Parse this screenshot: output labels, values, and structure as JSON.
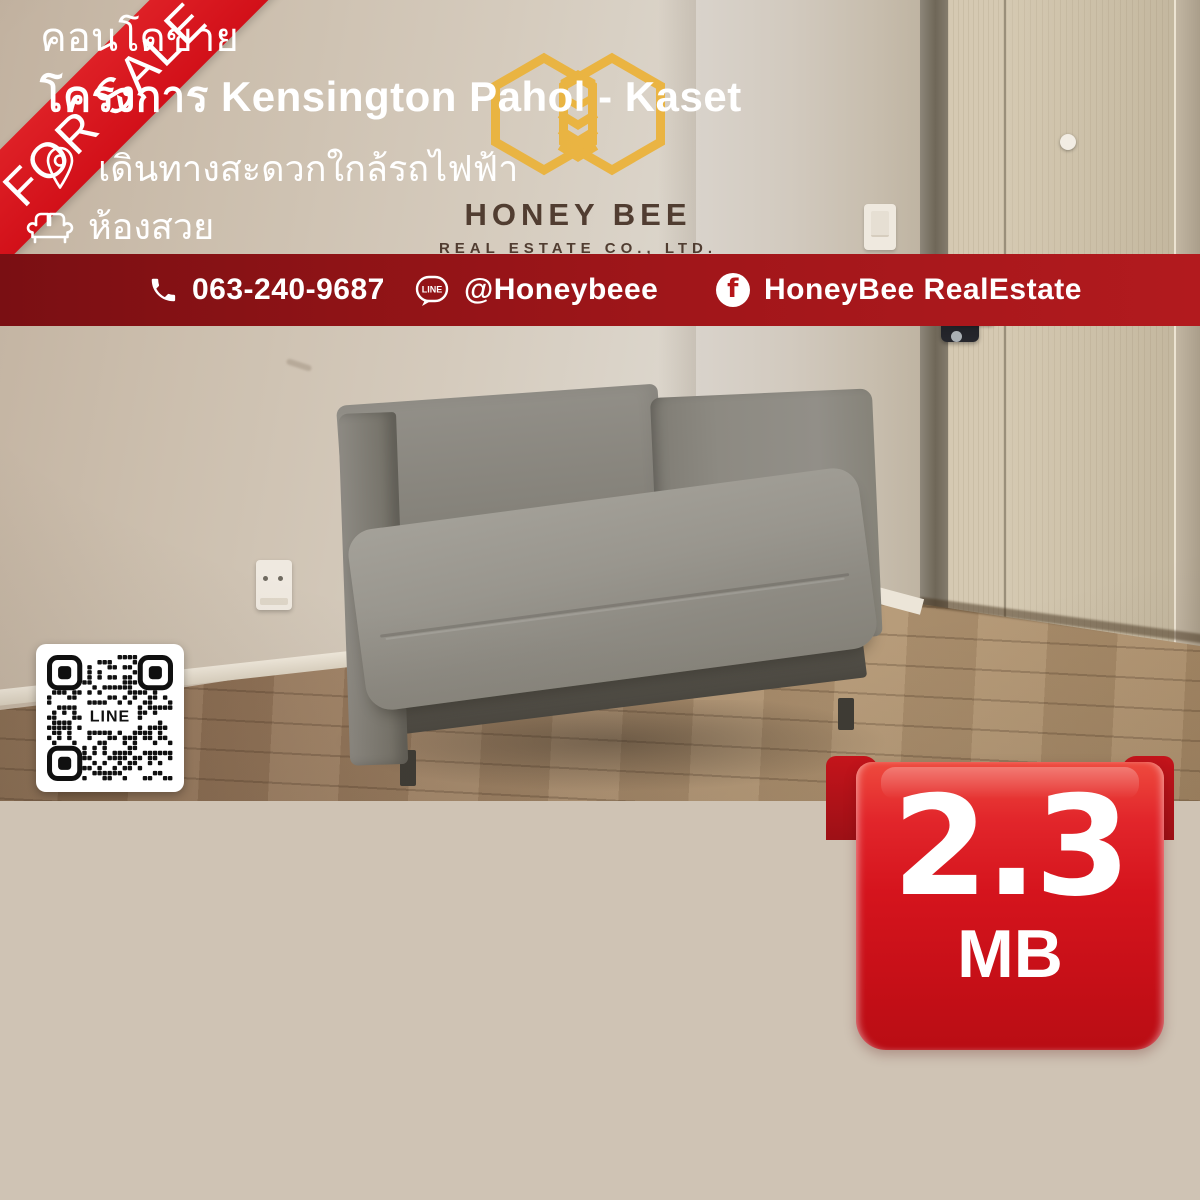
{
  "ribbon": {
    "label": "FOR SALE"
  },
  "logo": {
    "name": "HONEY BEE",
    "subtitle": "REAL ESTATE CO., LTD."
  },
  "qr": {
    "label": "LINE"
  },
  "listing": {
    "type": "คอนโดขาย",
    "project": "โครงการ Kensington Pahol - Kaset",
    "features": [
      {
        "icon": "location-pin-icon",
        "text": "เดินทางสะดวกใกล้รถไฟฟ้า"
      },
      {
        "icon": "sofa-icon",
        "text": "ห้องสวย"
      }
    ],
    "price": {
      "amount": "2.3",
      "unit": "MB"
    }
  },
  "contact": {
    "phone": "063-240-9687",
    "line_id": "@Honeybeee",
    "facebook": "HoneyBee RealEstate",
    "line_logo_text": "LINE",
    "facebook_letter": "f"
  },
  "colors": {
    "accent_red": "#d6141c",
    "panel_red": "#c91b20",
    "footer_red": "#8e1316",
    "gold": "#ebb33c",
    "brand_brown": "#4a362a"
  }
}
